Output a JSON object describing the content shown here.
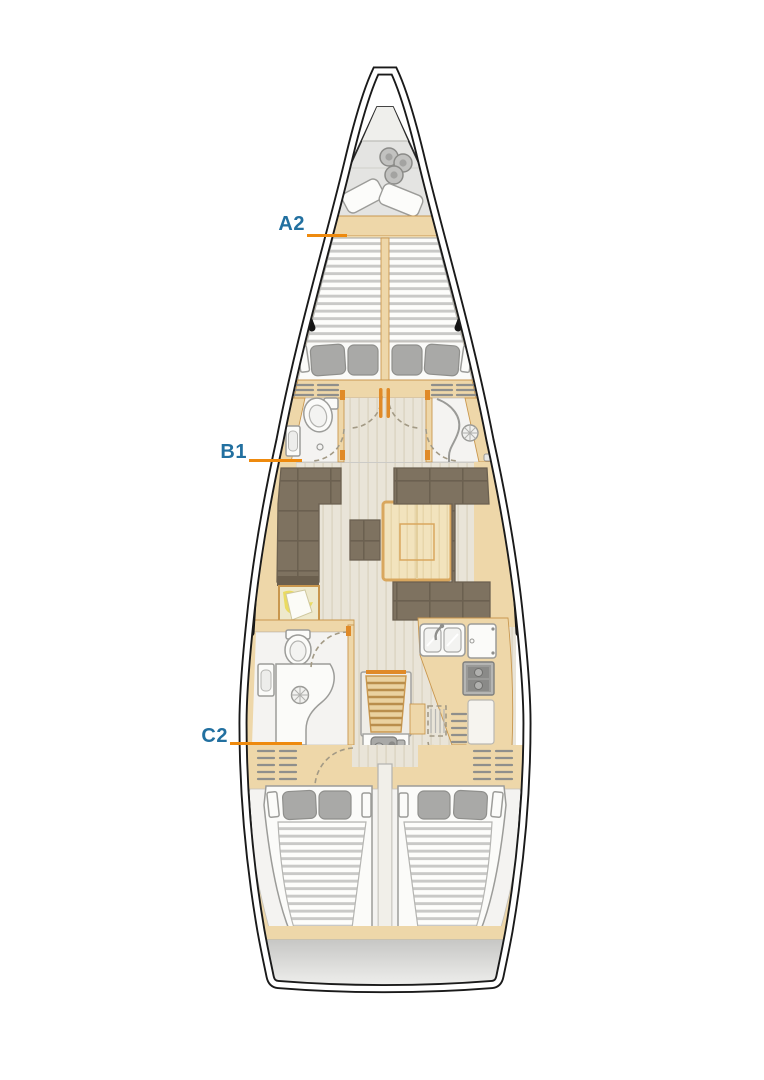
{
  "labels": [
    {
      "id": "A2",
      "text": "A2"
    },
    {
      "id": "B1",
      "text": "B1"
    },
    {
      "id": "C2",
      "text": "C2"
    }
  ],
  "colors": {
    "label_text": "#2270a0",
    "leader_line": "#ee8a0e",
    "hull_outline": "#1a1a1a",
    "wood_trim": "#eed7a9",
    "wood_edge": "#c9974e",
    "upholstery": "#7e7260",
    "upholstery_seam": "#6b6050",
    "floor_light": "#e9e4d8",
    "fixture_white": "#fbfbf9",
    "pillow_gray": "#a9a9a7",
    "table_wood": "#f2e3bd",
    "table_edge": "#d9a75e",
    "chart_map_yellow": "#e9d84e",
    "anchor_locker_gray": "#e4e4e2",
    "transom_gray": "#c9c9c7"
  }
}
